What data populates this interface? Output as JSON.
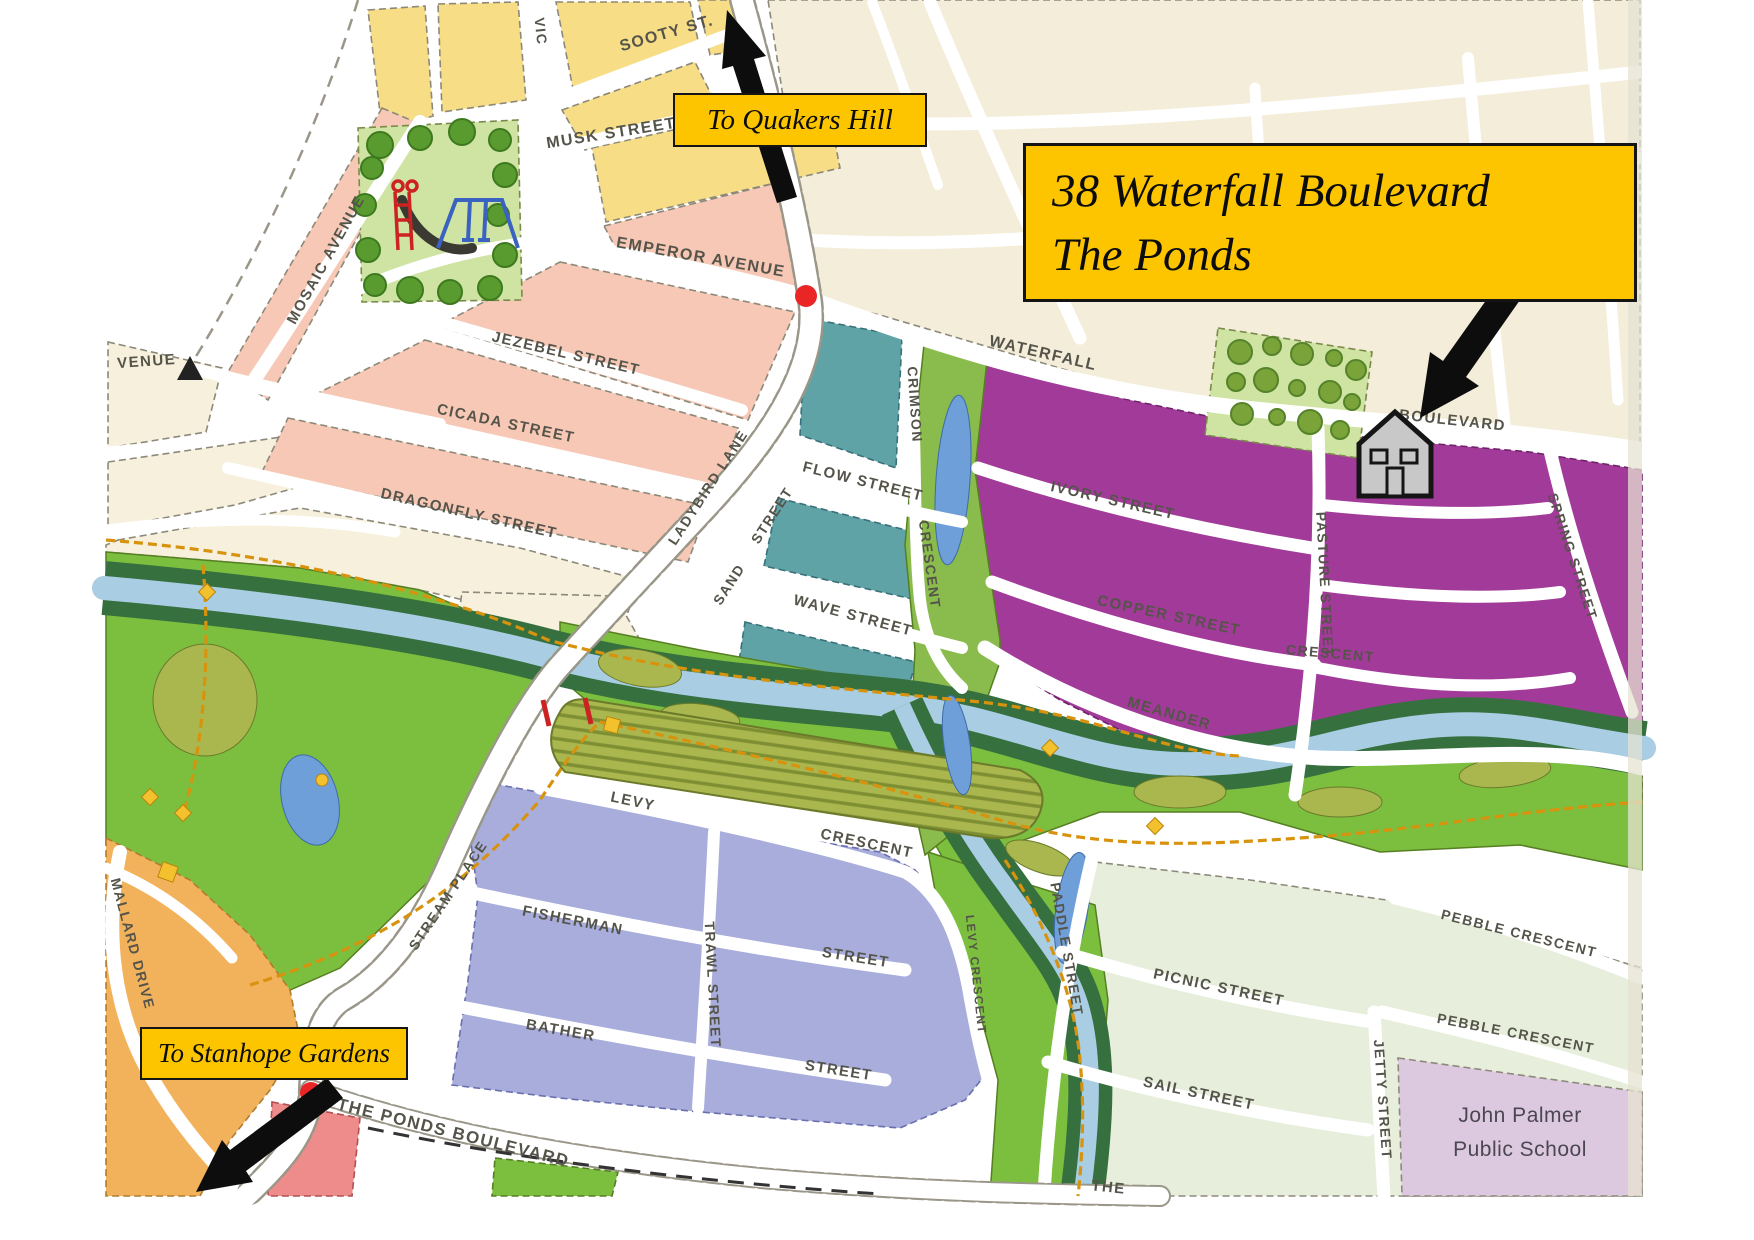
{
  "annotations": {
    "property_line1": "38 Waterfall Boulevard",
    "property_line2": "The Ponds",
    "to_quakers_hill": "To Quakers Hill",
    "to_stanhope_gardens": "To Stanhope Gardens"
  },
  "streets": {
    "sooty": "SOOTY ST.",
    "vic": "VIC",
    "musk": "MUSK STREET",
    "mosaic": "MOSAIC AVENUE",
    "venue_partial": "VENUE",
    "emperor": "EMPEROR AVENUE",
    "jezebel": "JEZEBEL STREET",
    "cicada": "CICADA STREET",
    "dragonfly": "DRAGONFLY STREET",
    "ladybird": "LADYBIRD LANE",
    "sand_1": "SAND",
    "sand_2": "STREET",
    "flow": "FLOW STREET",
    "wave": "WAVE STREET",
    "crimson_1": "CRIMSON",
    "crimson_2": "CRESCENT",
    "waterfall": "WATERFALL",
    "boulevard": "BOULEVARD",
    "ivory": "IVORY STREET",
    "copper": "COPPER STREET",
    "pasture": "PASTURE STREET",
    "spring": "SPRING STREET",
    "meander": "MEANDER",
    "meander_crescent": "CRESCENT",
    "levy": "LEVY",
    "levy_crescent": "CRESCENT",
    "levy_crescent_south": "LEVY CRESCENT",
    "fisherman": "FISHERMAN",
    "fisherman_street": "STREET",
    "bather": "BATHER",
    "bather_street": "STREET",
    "trawl": "TRAWL STREET",
    "stream_place": "STREAM PLACE",
    "the_ponds_boulevard": "THE PONDS BOULEVARD",
    "the_partial": "THE",
    "paddle": "PADDLE STREET",
    "picnic": "PICNIC STREET",
    "sail": "SAIL STREET",
    "jetty": "JETTY STREET",
    "pebble_upper": "PEBBLE CRESCENT",
    "pebble_lower": "PEBBLE CRESCENT",
    "mallard": "MALLARD DRIVE"
  },
  "places": {
    "school_line1": "John Palmer",
    "school_line2": "Public School"
  },
  "colors": {
    "annotation_yellow": "#fdc500",
    "block_purple": "#a23a99",
    "block_teal": "#5fa3a6",
    "block_lavender": "#a8addc",
    "block_pink": "#f6c8b5",
    "block_yellow": "#f6dd86",
    "block_cream": "#f3edd9",
    "block_pale_green": "#e7efdc",
    "school_pink": "#ddc9df",
    "park_green": "#7cbf3f",
    "creek_blue": "#a9cde2",
    "orange_block": "#f2b25c",
    "marker_red": "#e92525"
  }
}
